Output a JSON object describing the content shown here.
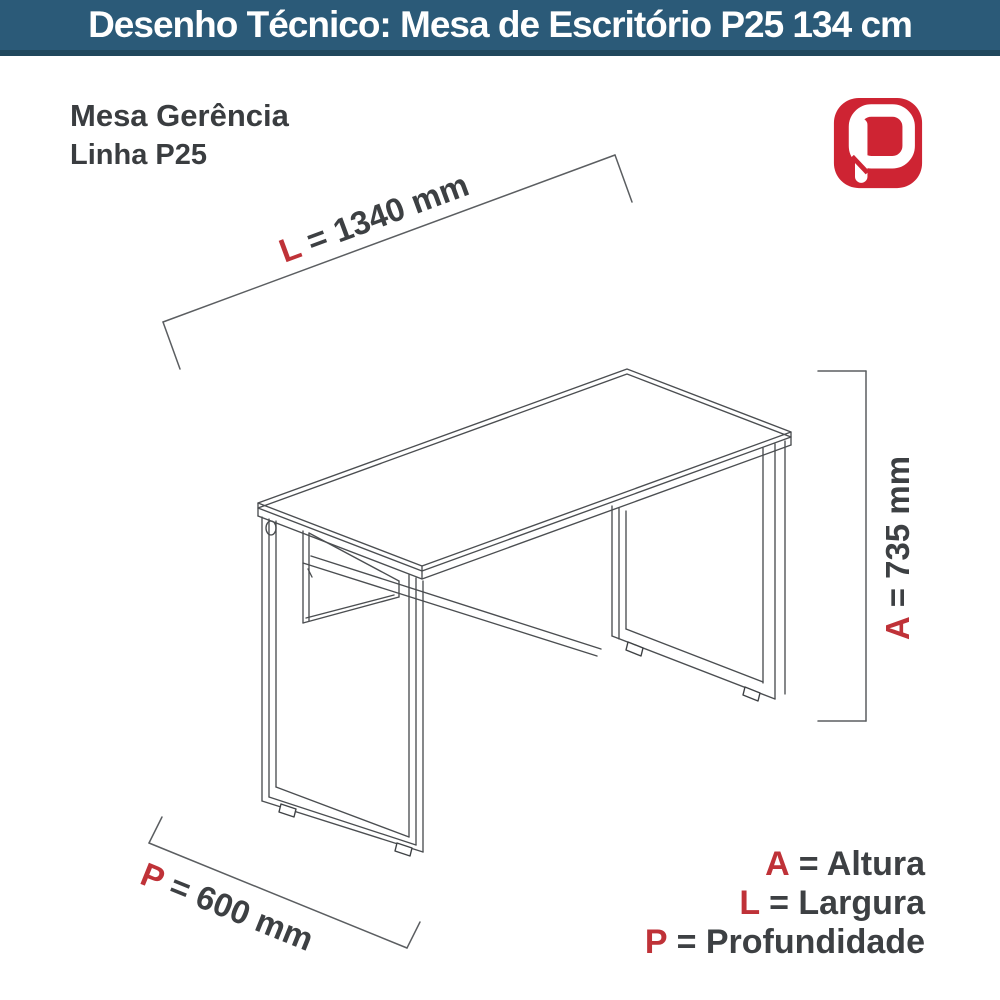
{
  "header": {
    "title": "Desenho Técnico:  Mesa de Escritório P25 134 cm"
  },
  "product": {
    "name": "Mesa Gerência",
    "line": "Linha P25"
  },
  "logo": {
    "letter": "P",
    "color": "#ce2433"
  },
  "dimensions": {
    "length": {
      "letter": "L",
      "rest": "= 1340 mm"
    },
    "height": {
      "letter": "A",
      "rest": "= 735 mm"
    },
    "depth": {
      "letter": "P",
      "rest": "= 600 mm"
    }
  },
  "legend": {
    "height": {
      "letter": "A",
      "rest": "= Altura"
    },
    "width": {
      "letter": "L",
      "rest": "= Largura"
    },
    "depth": {
      "letter": "P",
      "rest": "= Profundidade"
    }
  },
  "colors": {
    "header_bg": "#2b5a78",
    "header_border": "#20475d",
    "accent_red": "#bf3238",
    "logo_red": "#ce2433",
    "text_dark": "#3d4043",
    "line_gray": "#4b4e51"
  }
}
